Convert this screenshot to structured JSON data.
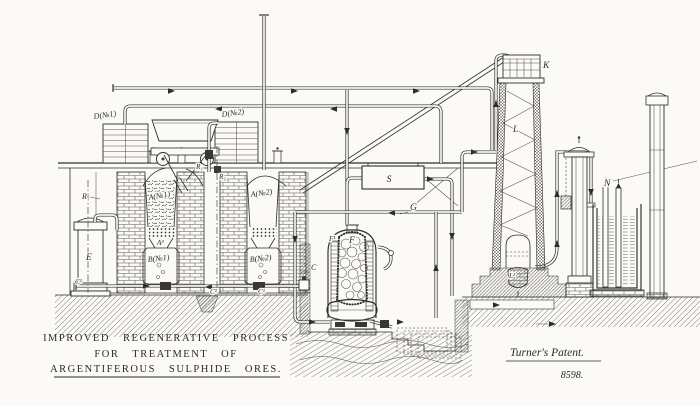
{
  "drawing": {
    "paper_color": "#fbfaf6",
    "ink_color": "#2e2d2b",
    "title_lines": [
      "IMPROVED REGENERATIVE PROCESS",
      "FOR TREATMENT OF",
      "ARGENTIFEROUS SULPHIDE ORES."
    ],
    "attribution": "Turner's Patent.",
    "patent_number": "8598."
  },
  "labels": {
    "d_no1": "D(№1)",
    "d_no2": "D(№2)",
    "r": "R",
    "r1": "R₁",
    "r2": "R₂",
    "e": "E",
    "a_no1": "A(№1)",
    "a_no2": "A(№2)",
    "a2": "A²",
    "b_no1": "B(№1)",
    "b_no2": "B(№2)",
    "c": "C",
    "c1_left": "C¹",
    "c1_mid": "C¹",
    "c1_right": "C¹",
    "s": "S",
    "g": "G",
    "f": "F",
    "f1": "F¹",
    "k": "K",
    "l": "L",
    "l2": "L²",
    "n": "N"
  }
}
